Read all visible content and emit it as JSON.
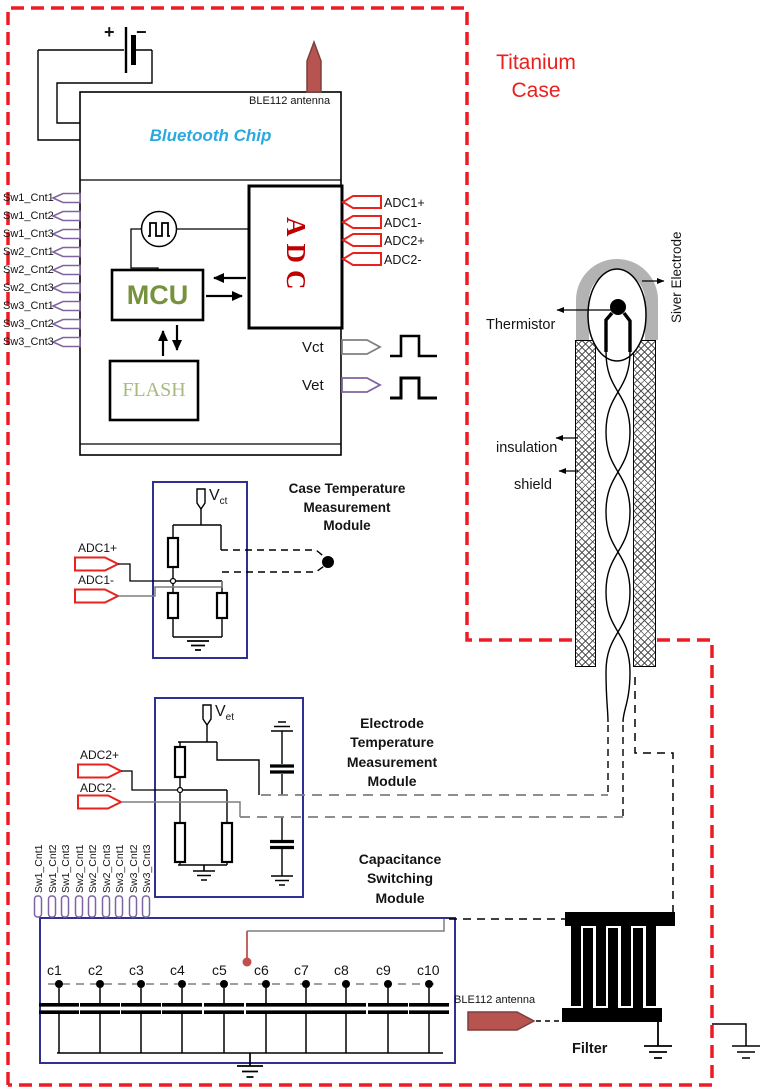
{
  "titanium_case": {
    "line1": "Titanium",
    "line2": "Case"
  },
  "battery": {
    "plus": "+",
    "minus": "−"
  },
  "chip": {
    "antenna_label": "BLE112 antenna",
    "title": "Bluetooth Chip",
    "mcu": "MCU",
    "flash": "FLASH",
    "adc": "ADC",
    "vct": "Vct",
    "vet": "Vet"
  },
  "sw_pins": [
    "Sw1_Cnt1",
    "Sw1_Cnt2",
    "Sw1_Cnt3",
    "Sw2_Cnt1",
    "Sw2_Cnt2",
    "Sw2_Cnt3",
    "Sw3_Cnt1",
    "Sw3_Cnt2",
    "Sw3_Cnt3"
  ],
  "adc_pins": [
    "ADC1+",
    "ADC1-",
    "ADC2+",
    "ADC2-"
  ],
  "case_module": {
    "title1": "Case Temperature",
    "title2": "Measurement",
    "title3": "Module",
    "v_main": "V",
    "v_sub": "ct",
    "pin_plus": "ADC1+",
    "pin_minus": "ADC1-"
  },
  "electrode_module": {
    "title1": "Electrode",
    "title2": "Temperature",
    "title3": "Measurement",
    "title4": "Module",
    "v_main": "V",
    "v_sub": "et",
    "pin_plus": "ADC2+",
    "pin_minus": "ADC2-"
  },
  "cap_module": {
    "title1": "Capacitance",
    "title2": "Switching",
    "title3": "Module",
    "caps": [
      "c1",
      "c2",
      "c3",
      "c4",
      "c5",
      "c6",
      "c7",
      "c8",
      "c9",
      "c10"
    ]
  },
  "probe": {
    "thermistor": "Thermistor",
    "silver_electrode": "Siver Electrode",
    "insulation": "insulation",
    "shield": "shield"
  },
  "filter_section": {
    "label": "Filter",
    "antenna_label": "BLE112 antenna"
  },
  "colors": {
    "case_red": "#ED1C24",
    "module_blue": "#2E3192",
    "connector_purple": "#8064A2",
    "pin_red": "#E8231E",
    "antenna_fill": "#B85450",
    "mcu_green": "#76923C",
    "flash_green": "#A6BA80",
    "adc_red": "#C00000",
    "chip_blue": "#29A9E0"
  }
}
